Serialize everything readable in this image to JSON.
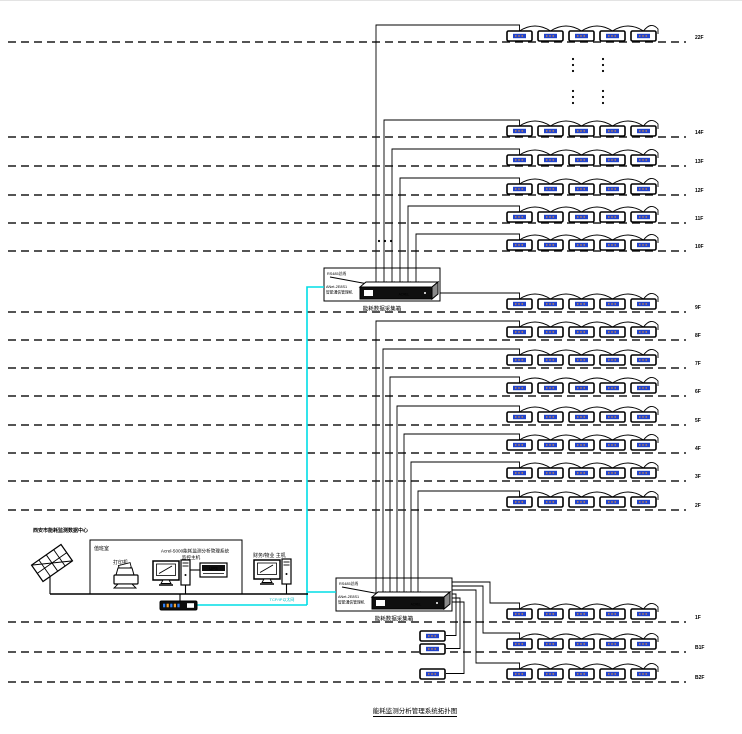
{
  "title": "能耗监测分析管理系统拓扑图",
  "colors": {
    "ink": "#000000",
    "ethernet": "#00dde6",
    "meter_display": "#2244cc",
    "meter_digit": "#ff9922"
  },
  "data_center": {
    "label": "西安市能耗监测数据中心"
  },
  "duty_room": {
    "label": "值班室",
    "printer_label": "打印机",
    "host_label_line1": "Acrel-5000能耗监测分析管理系统",
    "host_label_line2": "监控主机",
    "ups_label": "UPS"
  },
  "finance_host": {
    "label": "财务/物业 主机"
  },
  "network": {
    "ethernet_label": "TCP/IP以太网"
  },
  "gateway": {
    "bus_label": "RS485总线",
    "device_line1": "ANet-2E8S1",
    "device_line2": "智能通信管理机",
    "brand": "ACREL",
    "caption": "能耗数据采集箱"
  },
  "floors": [
    {
      "label": "22F",
      "meters": 5
    },
    {
      "label": "14F",
      "meters": 5
    },
    {
      "label": "13F",
      "meters": 5
    },
    {
      "label": "12F",
      "meters": 5
    },
    {
      "label": "11F",
      "meters": 5
    },
    {
      "label": "10F",
      "meters": 5
    },
    {
      "label": "9F",
      "meters": 5
    },
    {
      "label": "8F",
      "meters": 5
    },
    {
      "label": "7F",
      "meters": 5
    },
    {
      "label": "6F",
      "meters": 5
    },
    {
      "label": "5F",
      "meters": 5
    },
    {
      "label": "4F",
      "meters": 5
    },
    {
      "label": "3F",
      "meters": 5
    },
    {
      "label": "2F",
      "meters": 5
    },
    {
      "label": "1F",
      "meters": 5
    },
    {
      "label": "B1F",
      "meters": 5
    },
    {
      "label": "B2F",
      "meters": 5
    }
  ],
  "standalone_meters": 3
}
